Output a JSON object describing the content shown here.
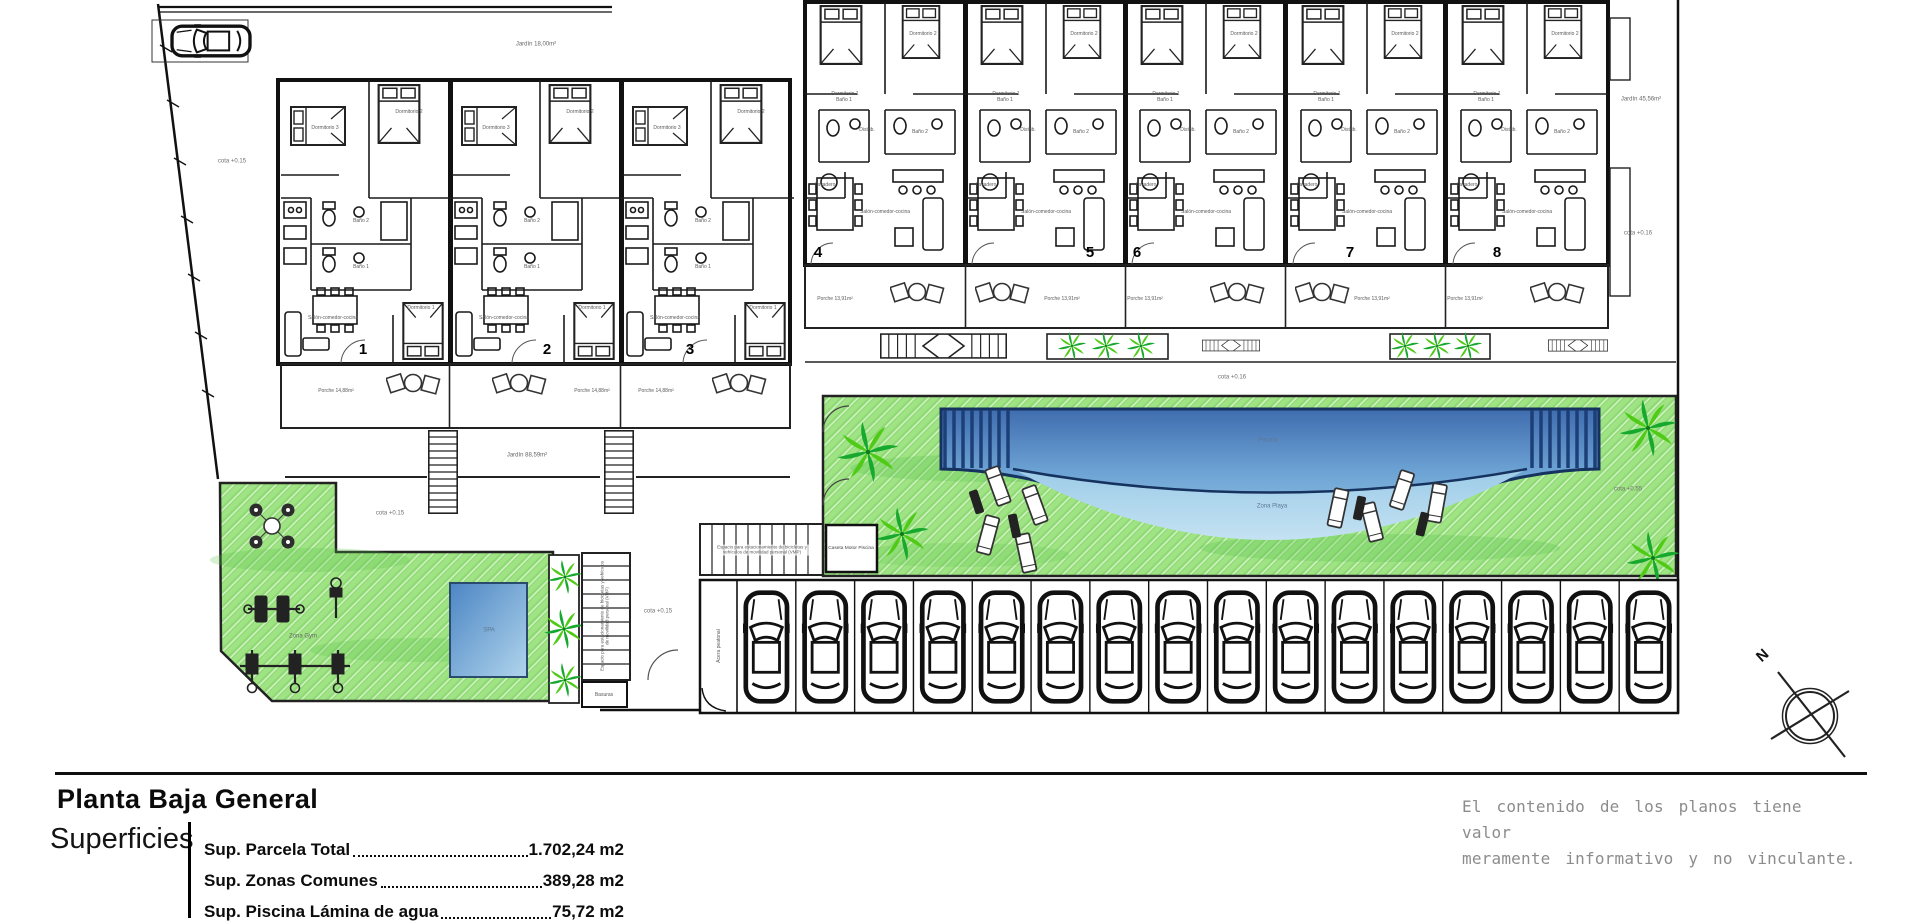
{
  "title_block": {
    "title": "Planta Baja General",
    "section_label": "Superficies",
    "surfaces": [
      {
        "label": "Sup. Parcela Total",
        "value": "1.702,24 m2"
      },
      {
        "label": "Sup. Zonas Comunes",
        "value": "389,28 m2"
      },
      {
        "label": "Sup. Piscina Lámina de agua",
        "value": "75,72 m2"
      }
    ],
    "disclaimer": [
      "El contenido de los planos tiene valor",
      "meramente informativo y no vinculante."
    ]
  },
  "plan": {
    "compass": "N",
    "units_left": [
      "1",
      "2",
      "3"
    ],
    "units_right": [
      "4",
      "5",
      "6",
      "7",
      "8"
    ],
    "rooms": {
      "dormitorio1": "Dormitorio 1",
      "dormitorio2": "Dormitorio 2",
      "dormitorio3": "Dormitorio 3",
      "bano1": "Baño 1",
      "bano2": "Baño 2",
      "salon": "Salón-comedor-cocina",
      "lavadero": "Lavadero",
      "distribuidor": "Distrib."
    },
    "labels": {
      "porche_left": "Porche 14,88m²",
      "porche_right": "Porche 13,91m²",
      "jardin_left": "Jardín 88,59m²",
      "jardin_top": "Jardín 18,00m²",
      "jardin_right": "Jardín 45,56m²",
      "cota_015": "cota +0.15",
      "cota_016": "cota +0.16",
      "cota_055": "cota +0.55",
      "piscina": "Piscina",
      "zona_playa": "Zona Playa",
      "spa": "SPA",
      "zona_gym": "Zona Gym",
      "caseta": "Caseta Motor Piscina",
      "basuras": "Basuras",
      "bike_note": "Espacio para estacionamiento de bicicletas y vehículos de movilidad personal (VMP)",
      "acera": "Acera peatonal"
    },
    "parking": {
      "spaces": 16
    }
  },
  "colors": {
    "grass": "#8dd973",
    "pool_dark": "#3f6cae",
    "pool_light": "#8fc2e2",
    "playa": "#b9dcef",
    "wall": "#111111",
    "disclaimer_gray": "#8c8c8c"
  }
}
